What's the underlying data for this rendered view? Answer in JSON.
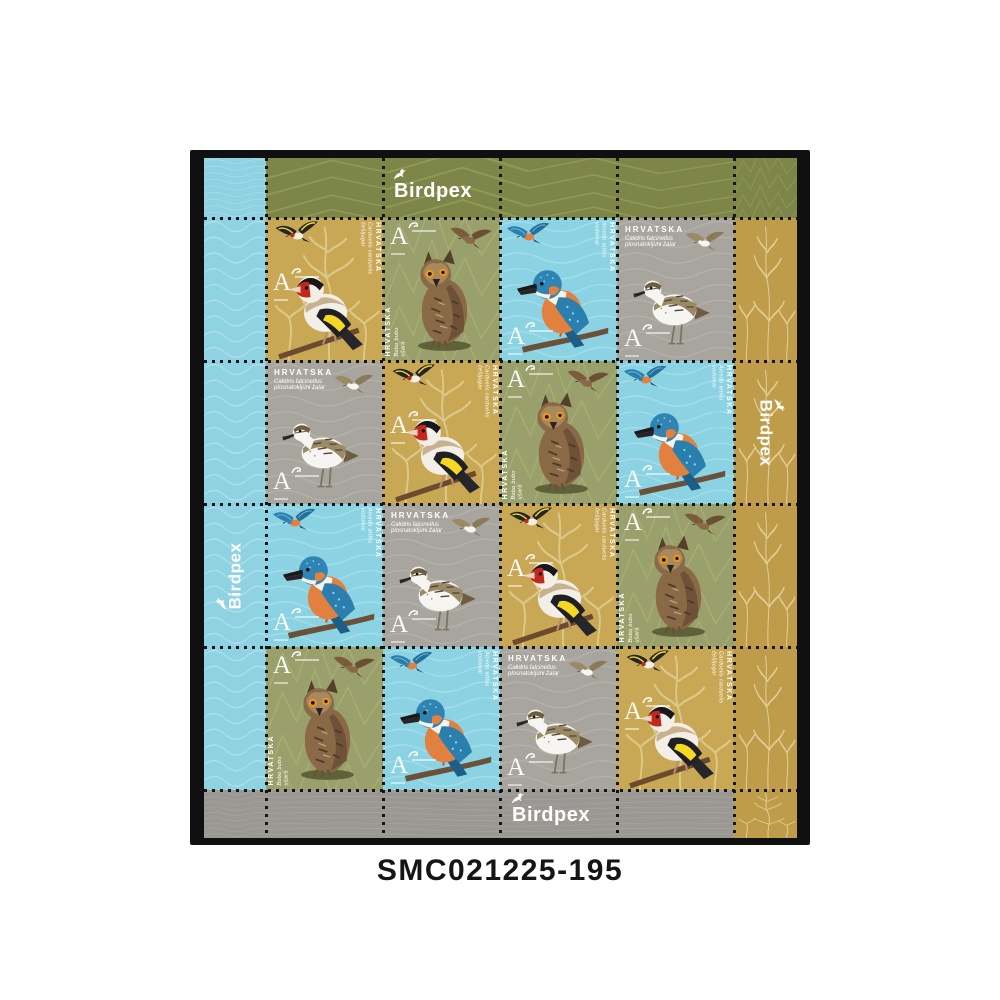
{
  "caption": "SMC021225-195",
  "brand": {
    "name": "Birdpex"
  },
  "sheet": {
    "country": "HRVATSKA",
    "denomination": "A",
    "margin_logos": {
      "top": "Birdpex",
      "bottom": "Birdpex",
      "left": "Birdpex",
      "right": "Birdpex"
    },
    "stamps": {
      "goldfinch": {
        "country": "HRVATSKA",
        "latin": "Carduelis carduelis",
        "croatian": "češljugar",
        "denomination": "A",
        "background": "#c9a855"
      },
      "owl": {
        "country": "HRVATSKA",
        "latin": "Bubo bubo",
        "croatian": "ušara",
        "denomination": "A",
        "background": "#99a06b"
      },
      "kingfisher": {
        "country": "HRVATSKA",
        "latin": "Alcedo atthis",
        "croatian": "vodomar",
        "denomination": "A",
        "background": "#8bd2e2"
      },
      "sandpiper": {
        "country": "HRVATSKA",
        "latin": "Calidris falcinellus",
        "croatian": "plosnatokljuni žalar",
        "denomination": "A",
        "background": "#a8a49e"
      }
    },
    "grid": [
      [
        "goldfinch",
        "owl",
        "kingfisher",
        "sandpiper"
      ],
      [
        "sandpiper",
        "goldfinch",
        "owl",
        "kingfisher"
      ],
      [
        "kingfisher",
        "sandpiper",
        "goldfinch",
        "owl"
      ],
      [
        "owl",
        "kingfisher",
        "sandpiper",
        "goldfinch"
      ]
    ],
    "colors": {
      "page_bg": "#ffffff",
      "photo_bg": "#101010",
      "margin_blue": "#8fd2e1",
      "banner_olive": "#7d8648",
      "stamp_olive": "#99a06b",
      "stamp_gold": "#c9a855",
      "margin_gold": "#bf9c4a",
      "stamp_gray": "#a8a49e",
      "banner_gray": "#9b9894",
      "perforation": "#141414",
      "logo_white": "#ffffff"
    }
  }
}
